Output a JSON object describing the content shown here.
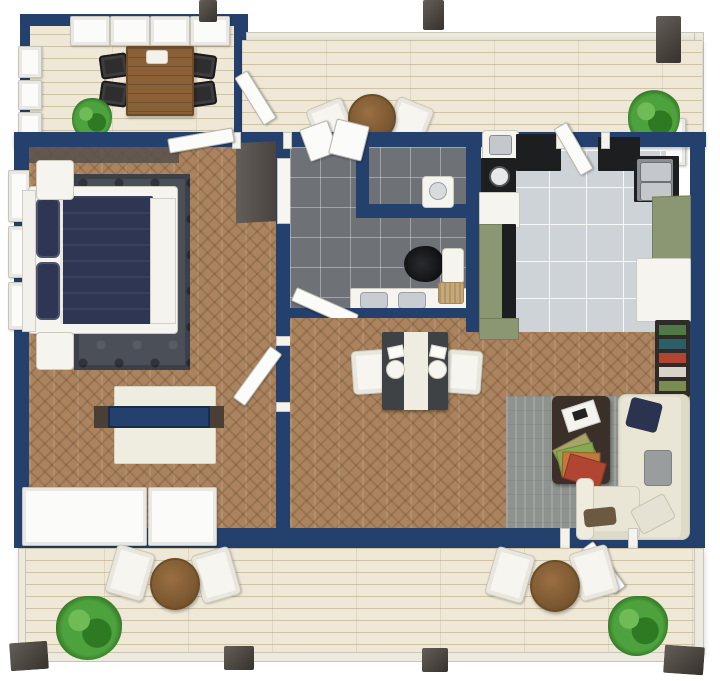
{
  "scene": {
    "type": "3d-floor-plan-top-down-render",
    "description": "One-bedroom apartment floor plan with navy walls, an enclosed balcony, a top roof deck and a lower deck",
    "visible_text": []
  },
  "palette": {
    "wall-navy": "#24416e",
    "wall-inner": "#57504b",
    "deck-wood": "#efe8d7",
    "floor-wood": "#ab845f",
    "tile-dark": "#6e7277",
    "tile-light": "#ced3d8",
    "rug-dark": "#4a4f58",
    "rug-gray": "#8f938f",
    "duvet-navy": "#2f3654",
    "cream": "#efece0",
    "sage-green": "#8b9672",
    "counter-black": "#1d1e20",
    "steel": "#c4c8cc",
    "table-wood": "#8a6137",
    "coffee-table": "#3a3029",
    "chair-black": "#2e2e2e",
    "plant-green": "#4da23e",
    "post-brown": "#49423b",
    "drawer-beige": "#ded4b8",
    "basket-tan": "#c9a878"
  },
  "rooms": [
    {
      "name": "balcony",
      "floor": "light wood deck",
      "items": [
        "wood dining table",
        "white dish",
        "4 black folding chairs",
        "potted plant",
        "white framed window walls"
      ]
    },
    {
      "name": "roof-deck",
      "floor": "light wood deck",
      "items": [
        "round bistro table",
        "2 white chairs",
        "planter with plant",
        "railing",
        "3 dark posts",
        "open entry door"
      ]
    },
    {
      "name": "bedroom",
      "floor": "herringbone wood",
      "items": [
        "double bed with navy duvet",
        "white headboard bench",
        "2 white nightstands",
        "dark patterned rug",
        "tv sideboard with navy shelf",
        "dark wardrobe",
        "window walls"
      ]
    },
    {
      "name": "bathroom",
      "floor": "dark gray tile",
      "items": [
        "shower room",
        "wc room with sink",
        "toilet with black lid",
        "double sink vanity",
        "storage basket",
        "open window",
        "door to dining"
      ]
    },
    {
      "name": "kitchen",
      "floor": "light gray tile",
      "items": [
        "double stainless sink",
        "black counters",
        "cooktop",
        "sage green cabinets",
        "refrigerator",
        "planter box",
        "open deck door"
      ]
    },
    {
      "name": "dining-area",
      "floor": "herringbone wood",
      "items": [
        "dark dining table with white runner",
        "2 white chairs",
        "2 place settings",
        "white console with 3 drawers"
      ]
    },
    {
      "name": "living-room",
      "floor": "herringbone wood",
      "items": [
        "cream l-shaped sectional sofa",
        "dark brown coffee table",
        "magazines",
        "gray rug",
        "bookshelf with colorful books",
        "throw pillows",
        "deck door"
      ]
    },
    {
      "name": "lower-deck",
      "floor": "light wood deck",
      "items": [
        "2 round bistro tables",
        "4 white chairs",
        "2 potted plants",
        "railing",
        "4 dark posts"
      ]
    }
  ]
}
